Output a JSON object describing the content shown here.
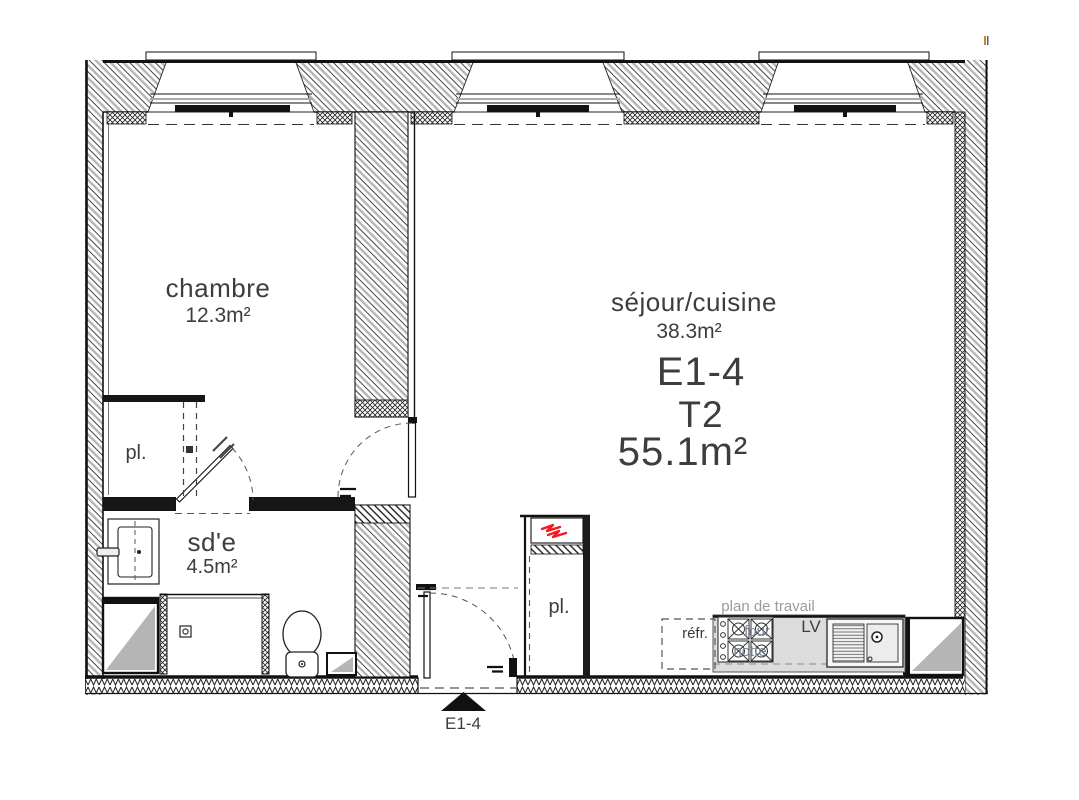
{
  "unit": {
    "code": "E1-4",
    "type": "T2",
    "total_area": "55.1m²"
  },
  "rooms": {
    "chambre": {
      "name": "chambre",
      "area": "12.3m²"
    },
    "sejour": {
      "name": "séjour/cuisine",
      "area": "38.3m²"
    },
    "sde": {
      "name": "sd'e",
      "area": "4.5m²"
    },
    "closet_chambre": {
      "name": "pl."
    },
    "closet_entry": {
      "name": "pl."
    }
  },
  "kitchen": {
    "worktop": "plan de travail",
    "fridge": "réfr.",
    "dishwasher": "LV",
    "oven": "four",
    "hood": "hotte"
  },
  "entry": {
    "marker": "E1-4"
  },
  "colors": {
    "red_symbol": "#ee1c25",
    "duct_gray": "#b5b5b5",
    "worktop_gray": "#dcdcdc",
    "text_dark": "#3d3d3d",
    "text_gray": "#9b9b9b"
  }
}
